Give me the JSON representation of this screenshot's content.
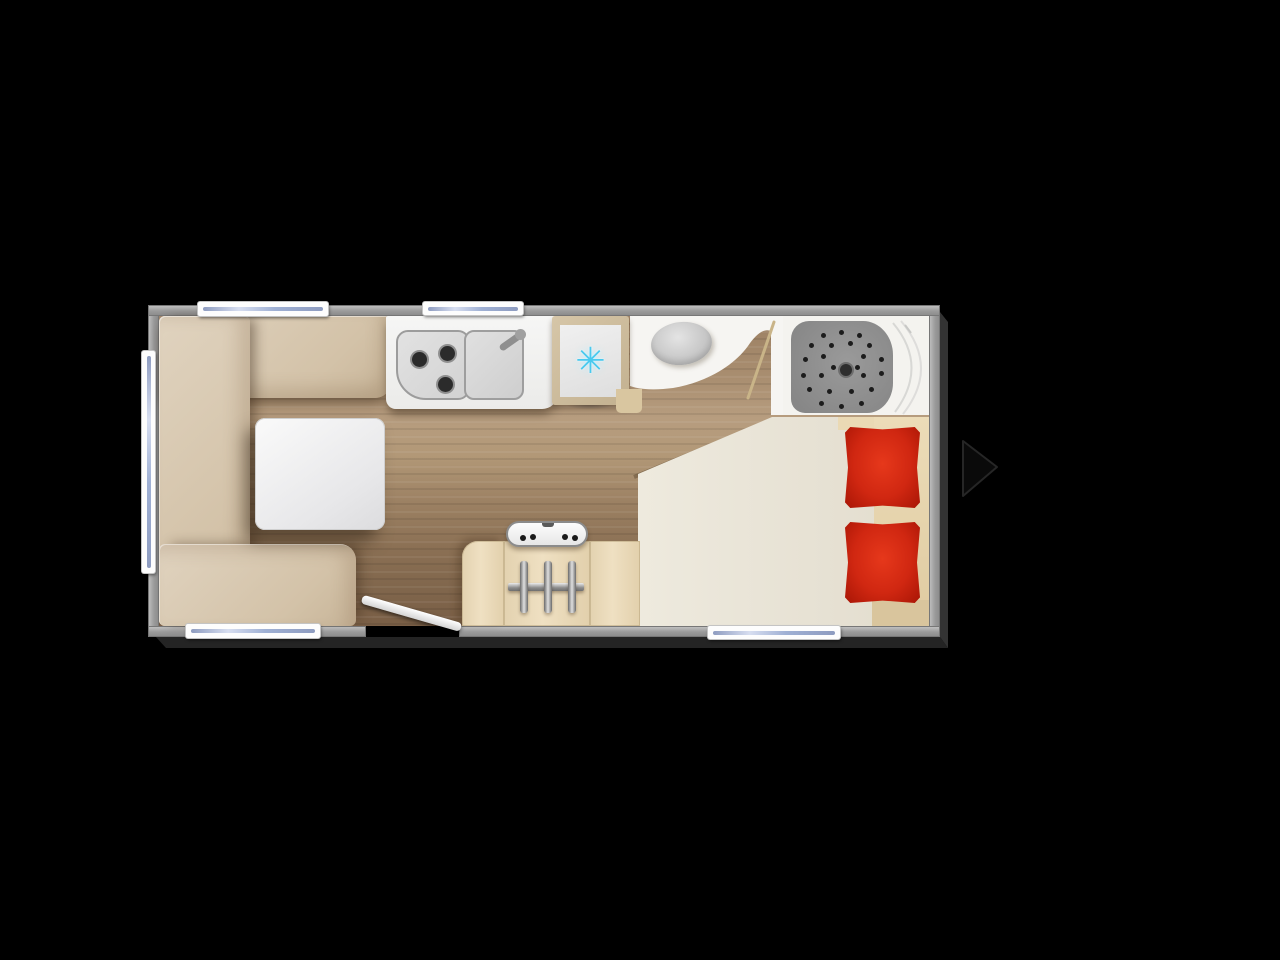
{
  "scene": {
    "type": "caravan-floorplan-top-view",
    "background": "#000000",
    "visible_text": "none"
  },
  "colors": {
    "wall": "#a9a9a9",
    "wood_mid": "#a98e70",
    "sofa_beige": "#d8c9b3",
    "counter_white": "#f2f2f0",
    "fridge_frame": "#cdbc9c",
    "snowflake_cyan": "#49c9ee",
    "bathroom_floor": "#f6f5f2",
    "shower_tray_gray": "#8f8f8f",
    "bed_cream": "#eae5da",
    "bed_band_beige": "#e7d6b0",
    "pillow_red": "#d02711",
    "cabinet_beige": "#e8d8ba",
    "window_glass_blue": "#aab6d8"
  },
  "fridge": {
    "icon_glyph": "✳",
    "label": "refrigerator"
  },
  "windows": [
    {
      "id": "top-window-left",
      "x": 198,
      "y": 302,
      "w": 130,
      "h": 14,
      "o": "h"
    },
    {
      "id": "top-window-right",
      "x": 423,
      "y": 302,
      "w": 100,
      "h": 13,
      "o": "h"
    },
    {
      "id": "left-window",
      "x": 142,
      "y": 351,
      "w": 13,
      "h": 222,
      "o": "v"
    },
    {
      "id": "bottom-window-left",
      "x": 186,
      "y": 624,
      "w": 134,
      "h": 14,
      "o": "h"
    },
    {
      "id": "bottom-window-right",
      "x": 708,
      "y": 626,
      "w": 132,
      "h": 13,
      "o": "h"
    }
  ],
  "kitchen": {
    "burners": [
      [
        14,
        20
      ],
      [
        42,
        14
      ],
      [
        40,
        45
      ]
    ]
  },
  "shower": {
    "dots": [
      [
        30,
        12
      ],
      [
        48,
        9
      ],
      [
        66,
        12
      ],
      [
        18,
        22
      ],
      [
        38,
        22
      ],
      [
        57,
        20
      ],
      [
        76,
        22
      ],
      [
        12,
        36
      ],
      [
        30,
        33
      ],
      [
        70,
        33
      ],
      [
        88,
        36
      ],
      [
        10,
        52
      ],
      [
        28,
        52
      ],
      [
        70,
        52
      ],
      [
        88,
        50
      ],
      [
        16,
        66
      ],
      [
        36,
        68
      ],
      [
        58,
        68
      ],
      [
        78,
        66
      ],
      [
        28,
        80
      ],
      [
        48,
        83
      ],
      [
        68,
        80
      ],
      [
        40,
        44
      ],
      [
        64,
        44
      ]
    ]
  },
  "heater": {
    "panel_dots": [
      [
        12,
        12
      ],
      [
        22,
        11
      ],
      [
        54,
        11
      ],
      [
        64,
        12
      ]
    ],
    "bars_x": [
      520,
      544,
      568
    ]
  },
  "bed": {
    "pillows": [
      {
        "x": 845,
        "y": 427,
        "w": 75,
        "h": 81
      },
      {
        "x": 845,
        "y": 522,
        "w": 75,
        "h": 81
      }
    ]
  },
  "entry_door": {
    "x": 358,
    "y": 623,
    "w": 103,
    "h": 9,
    "angle_deg": 16
  }
}
